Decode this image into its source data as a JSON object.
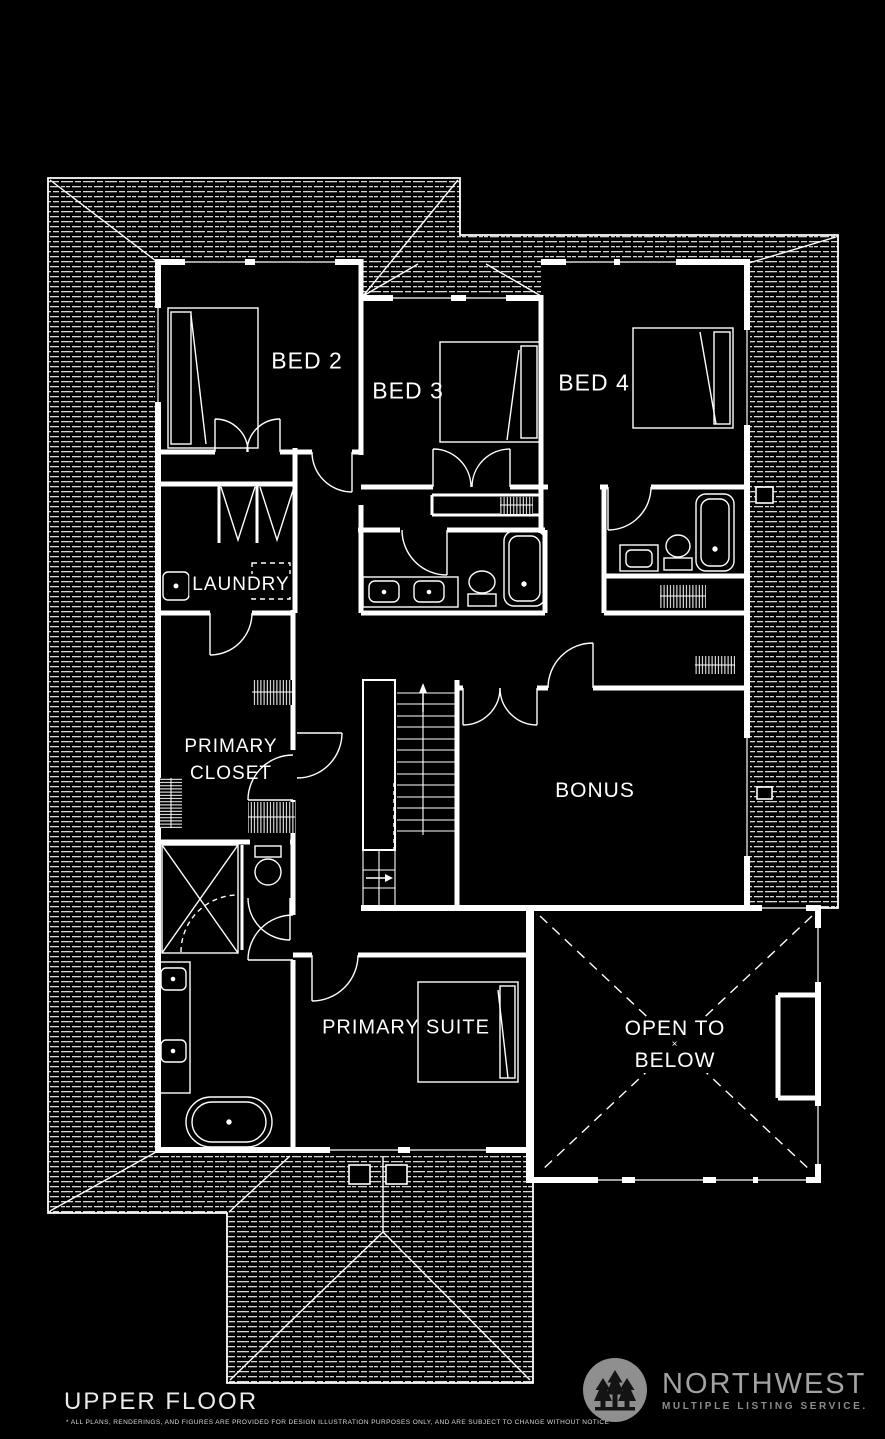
{
  "title": "UPPER FLOOR",
  "disclaimer": "* ALL PLANS, RENDERINGS, AND FIGURES ARE PROVIDED FOR DESIGN ILLUSTRATION PURPOSES ONLY, AND ARE SUBJECT TO CHANGE WITHOUT NOTICE",
  "rooms": {
    "bed2": "BED 2",
    "bed3": "BED 3",
    "bed4": "BED 4",
    "laundry": "LAUNDRY",
    "primary_closet_line1": "PRIMARY",
    "primary_closet_line2": "CLOSET",
    "bonus": "BONUS",
    "primary_suite": "PRIMARY SUITE",
    "open_line1": "OPEN TO",
    "open_x": "×",
    "open_line2": "BELOW"
  },
  "logo": {
    "name": "NORTHWEST",
    "tagline": "MULTIPLE LISTING SERVICE.",
    "icon": "pine-trees-icon"
  },
  "colors": {
    "background": "#000000",
    "lines": "#ffffff",
    "roof_hatch": "#d6d6d6",
    "logo_gray": "#9e9e9e"
  }
}
